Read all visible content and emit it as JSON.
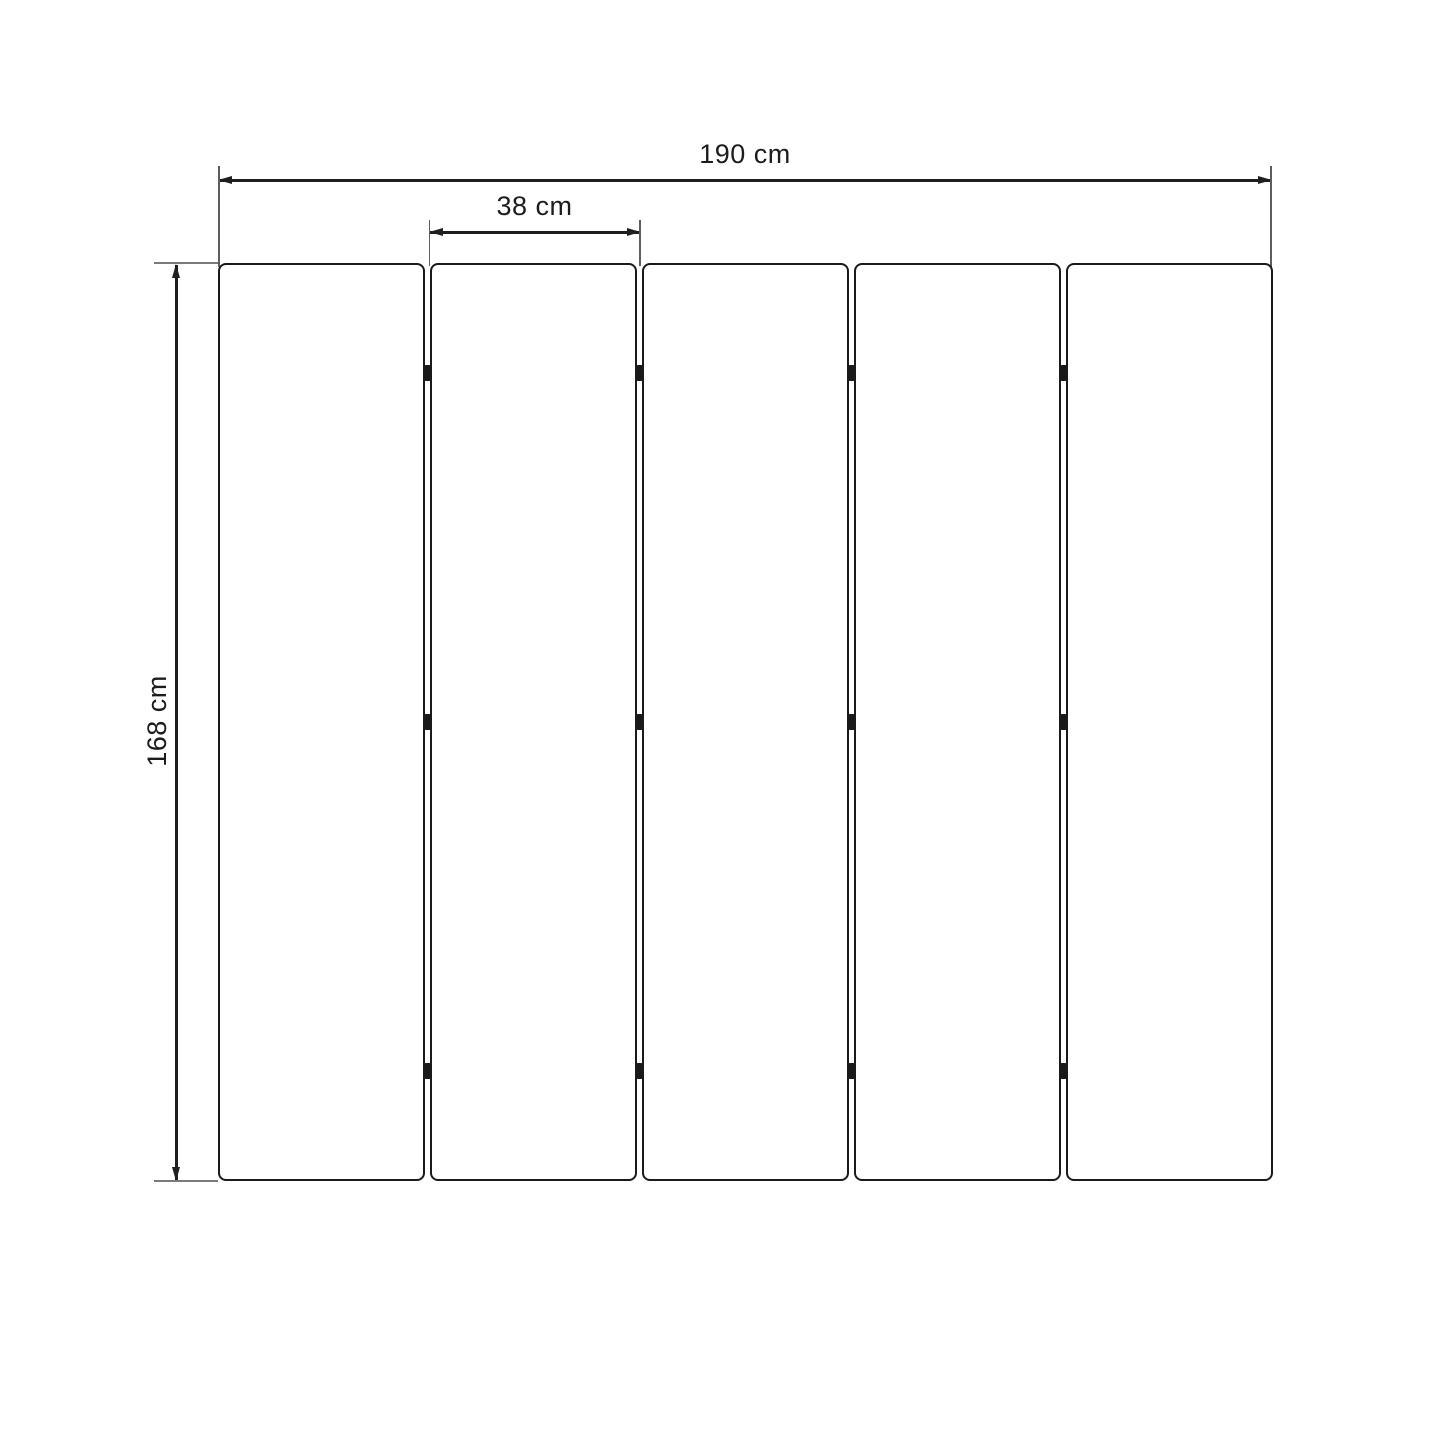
{
  "diagram": {
    "type": "dimension-drawing",
    "subject": "five-panel folding screen front view",
    "dimensions": {
      "total_width": {
        "label": "190 cm",
        "value": 190,
        "unit": "cm"
      },
      "panel_width": {
        "label": "38 cm",
        "value": 38,
        "unit": "cm"
      },
      "height": {
        "label": "168 cm",
        "value": 168,
        "unit": "cm"
      }
    },
    "panels": {
      "count": 5,
      "hinge_gaps": 4,
      "hinge_rows_per_gap": 3
    },
    "colors": {
      "line": "#1f1f1f",
      "panel_border": "#1a1a1a",
      "extension_line": "#7a7a7a",
      "background": "#ffffff",
      "panel_fill": "#ffffff"
    }
  }
}
